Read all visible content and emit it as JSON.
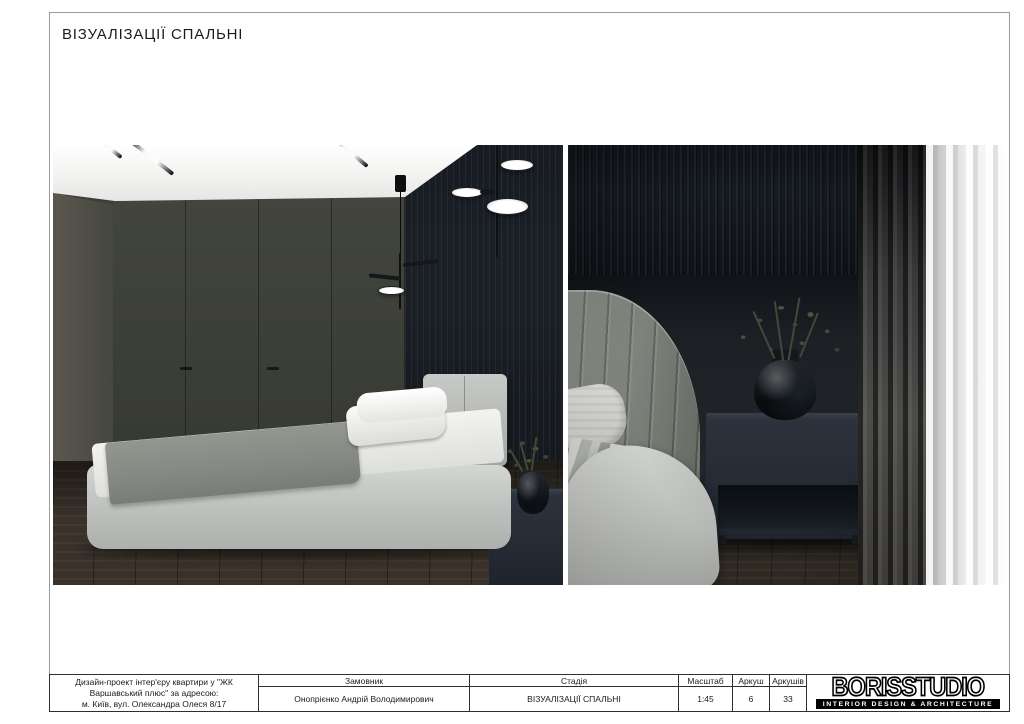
{
  "header": {
    "title": "ВІЗУАЛІЗАЦІЇ СПАЛЬНІ"
  },
  "title_block": {
    "project_description": {
      "line1": "Дизайн-проект інтер'єру квартири у \"ЖК",
      "line2": "Варшавський плюс\" за адресою:",
      "line3": "м. Київ, вул. Олександра Олеся 8/17"
    },
    "client": {
      "label": "Замовник",
      "value": "Онопрієнко Андрій Володимирович"
    },
    "stage": {
      "label": "Стадія",
      "value": "ВІЗУАЛІЗАЦІЇ СПАЛЬНІ"
    },
    "scale": {
      "label": "Масштаб",
      "value": "1:45"
    },
    "sheet": {
      "label": "Аркуш",
      "value": "6"
    },
    "sheets_total": {
      "label": "Аркушів",
      "value": "33"
    },
    "logo": {
      "brand": "BORISSTUDIO",
      "tagline": "INTERIOR DESIGN & ARCHITECTURE"
    }
  },
  "colors": {
    "frame_border": "#9a9a9a",
    "table_border": "#2f2f2f",
    "logo_bar": "#000000",
    "slat_wall": "#1b2027",
    "wardrobe_wall": "#3f423b",
    "bed_fabric": "#c7c9c6",
    "wood_floor": "#39312a",
    "sheer_curtain": "#f8f8f8"
  }
}
